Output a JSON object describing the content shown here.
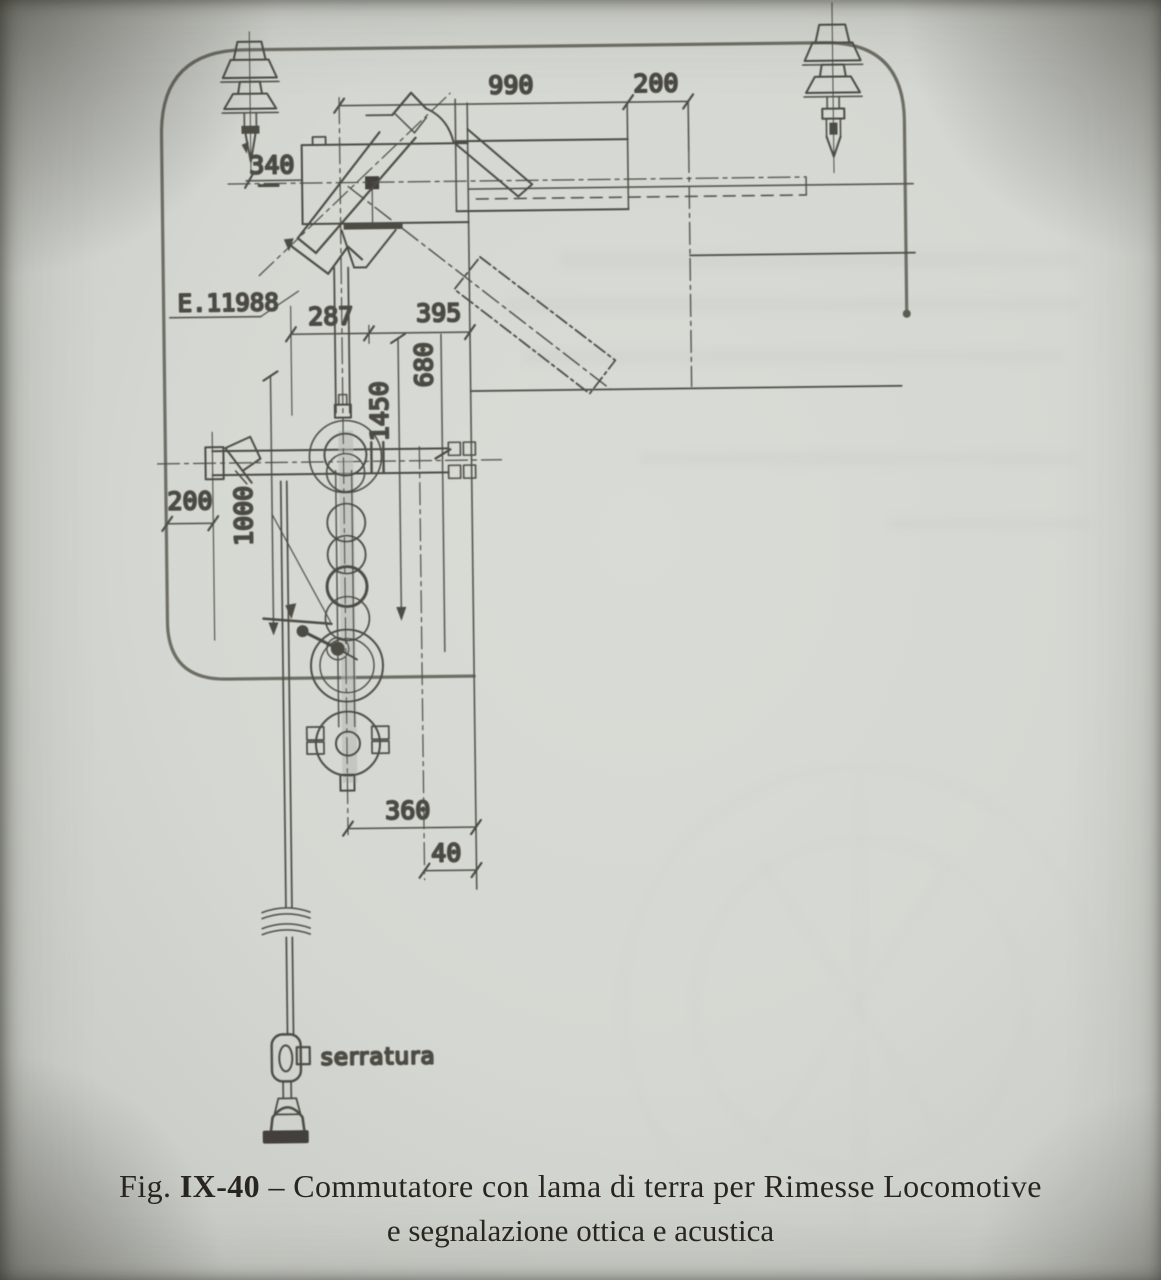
{
  "figure": {
    "caption": {
      "prefix": "Fig. ",
      "number": "IX-40",
      "separator": " – ",
      "line1": "Commutatore con lama di terra per Rimesse Locomotive",
      "line2": "e segnalazione ottica e acustica"
    },
    "reference": "E.11988",
    "lock_label": "serratura",
    "dimensions": {
      "span_top": "990",
      "offset_top": "200",
      "arm_offset": "340",
      "mast_span": "287",
      "blade_span": "395",
      "blade_drop": "680",
      "switch_height": "1450",
      "handle_offset": "200",
      "rod_length": "1000",
      "base_span": "360",
      "base_offset": "40"
    },
    "colors": {
      "paper": "#d5d7d2",
      "ink": "#45443e",
      "gauge_outline": "#68675f",
      "caption_ink": "#28251f"
    }
  }
}
